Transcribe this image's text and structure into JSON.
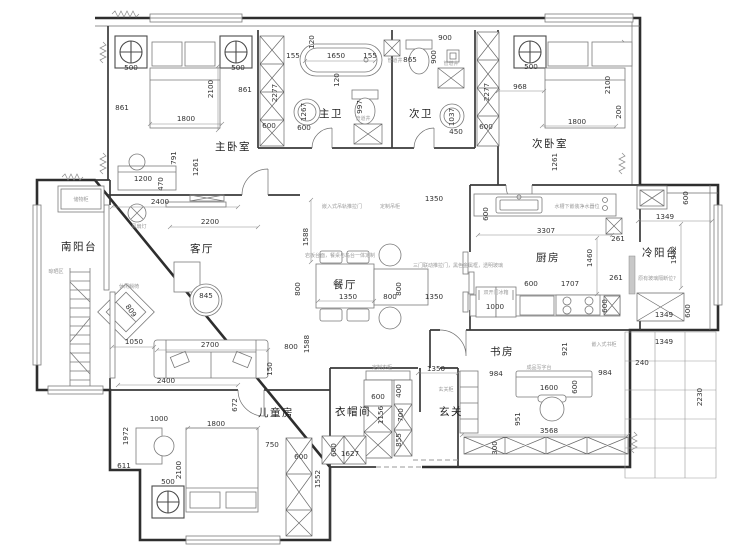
{
  "rooms": {
    "master": "主卧室",
    "mbath": "主卫",
    "sbath": "次卫",
    "second": "次卧室",
    "sbalcony": "南阳台",
    "living": "客厅",
    "dining": "餐厅",
    "kitchen": "厨房",
    "cbalcony": "冷阳台",
    "study": "书房",
    "kids": "儿童房",
    "cloak": "衣帽间",
    "foyer": "玄关"
  },
  "dims": {
    "master": [
      "500",
      "500",
      "2100",
      "861",
      "861",
      "1800",
      "791",
      "1261",
      "1200",
      "470"
    ],
    "mbath": [
      "155",
      "1650",
      "155",
      "120",
      "120",
      "1267",
      "997",
      "600"
    ],
    "sbath": [
      "865",
      "900",
      "900",
      "1037",
      "450"
    ],
    "shafts": [
      "2277",
      "600",
      "2277",
      "600"
    ],
    "second": [
      "500",
      "968",
      "2100",
      "1800",
      "200",
      "1261"
    ],
    "living": [
      "2400",
      "2200",
      "845",
      "1050",
      "2700",
      "150",
      "800",
      "1588",
      "809"
    ],
    "dining": [
      "1588",
      "800",
      "1350",
      "800",
      "800",
      "1350",
      "1350"
    ],
    "kitchen": [
      "600",
      "3307",
      "261",
      "1460",
      "261",
      "600",
      "1707",
      "1000",
      "600"
    ],
    "cold": [
      "600",
      "1349",
      "1932",
      "1349",
      "600",
      "1349",
      "240",
      "2230"
    ],
    "study": [
      "921",
      "984",
      "1600",
      "600",
      "984",
      "951",
      "3568",
      "300"
    ],
    "kids": [
      "2400",
      "672",
      "1000",
      "1800",
      "1972",
      "2100",
      "750",
      "600",
      "1552",
      "611",
      "500"
    ],
    "cloak": [
      "600",
      "1156",
      "400",
      "700",
      "855",
      "1627",
      "600"
    ],
    "foyer": [
      "1350"
    ]
  },
  "annotations": {
    "pipe": "管道井",
    "storage": "储物柜",
    "dry": "晾晒区",
    "lounge": "休闲躺椅",
    "fan": "风扇灯",
    "hall_door": "嵌入式吊轨推拉门",
    "hall_cabinet": "定制吊柜",
    "dining_table": "岩板台面，餐桌与岛台一体定制",
    "sliding_door": "三门联动推拉门，黑色金属框，透明玻璃",
    "water_filter": "水槽下嵌装净水器位",
    "fridge": "双开门冰箱",
    "desk": "成品写字台",
    "shelf": "嵌入式书柜",
    "glass": "原有玻璃隔断位?",
    "cloak_note": "定制衣柜",
    "shoe": "玄关柜"
  },
  "colors": {
    "wall": "#2e2e2e",
    "furniture": "#7a7a7a",
    "dimension": "#333333",
    "annotation": "#9a9a9a",
    "background": "#ffffff"
  }
}
